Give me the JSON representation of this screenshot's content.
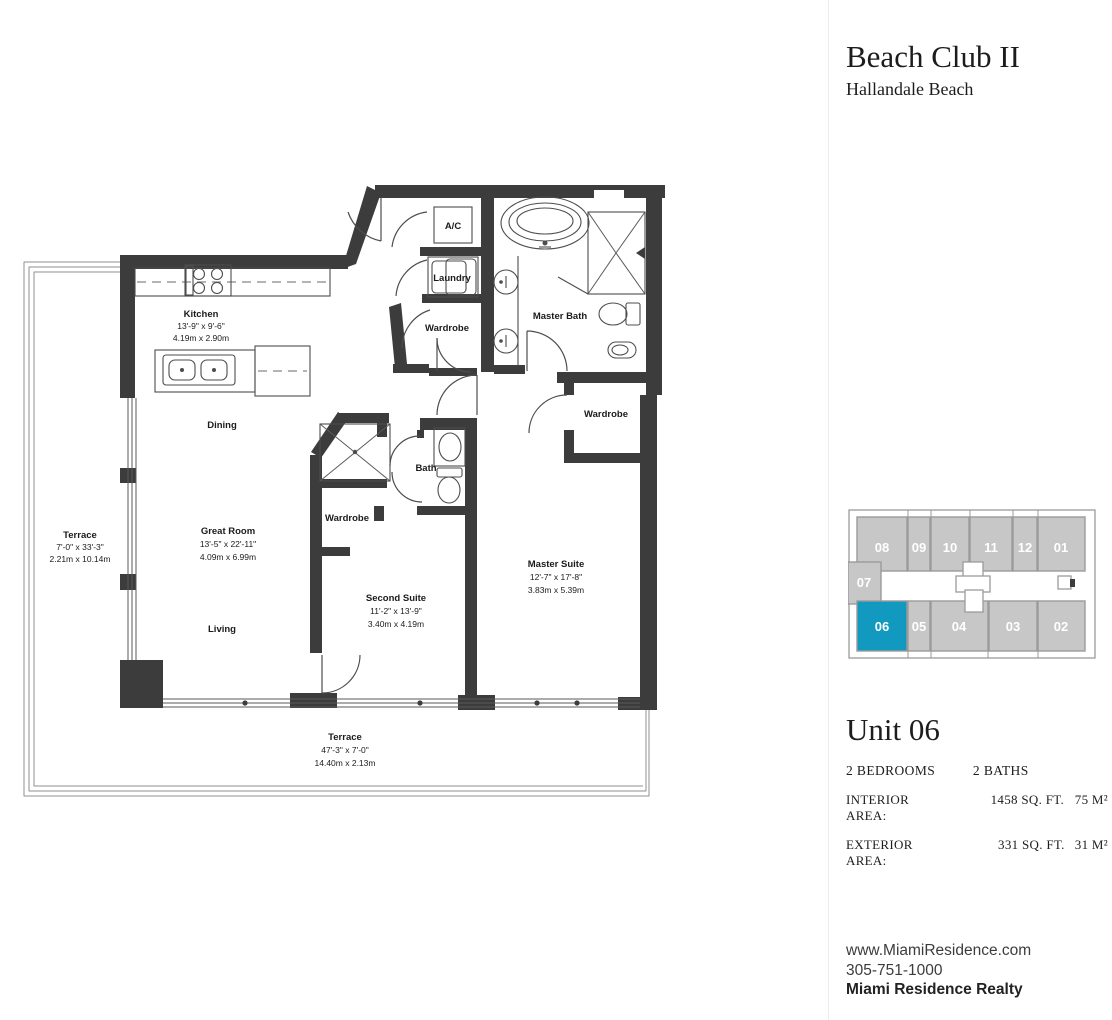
{
  "header": {
    "title": "Beach Club II",
    "subtitle": "Hallandale Beach"
  },
  "keyplan": {
    "highlight_color": "#1299bf",
    "highlighted_unit": "06",
    "units": [
      "08",
      "09",
      "10",
      "11",
      "12",
      "01",
      "07",
      "06",
      "05",
      "04",
      "03",
      "02"
    ]
  },
  "unit": {
    "name": "Unit 06",
    "bedrooms": "2 BEDROOMS",
    "baths": "2 BATHS",
    "interior_label": "INTERIOR AREA:",
    "interior_sqft": "1458 SQ. FT.",
    "interior_m2": "75 M²",
    "exterior_label": "EXTERIOR AREA:",
    "exterior_sqft": "331 SQ. FT.",
    "exterior_m2": "31 M²"
  },
  "contact": {
    "website": "www.MiamiResidence.com",
    "phone": "305-751-1000",
    "company": "Miami Residence Realty"
  },
  "floorplan": {
    "kitchen": {
      "name": "Kitchen",
      "ft": "13'-9\" x 9'-6\"",
      "m": "4.19m x 2.90m"
    },
    "dining": {
      "name": "Dining"
    },
    "living": {
      "name": "Living"
    },
    "great_room": {
      "name": "Great Room",
      "ft": "13'-5\" x 22'-11\"",
      "m": "4.09m x 6.99m"
    },
    "terrace_left": {
      "name": "Terrace",
      "ft": "7'-0\" x 33'-3\"",
      "m": "2.21m x 10.14m"
    },
    "terrace_bottom": {
      "name": "Terrace",
      "ft": "47'-3\" x 7'-0\"",
      "m": "14.40m x 2.13m"
    },
    "second_suite": {
      "name": "Second Suite",
      "ft": "11'-2\" x 13'-9\"",
      "m": "3.40m x 4.19m"
    },
    "master_suite": {
      "name": "Master Suite",
      "ft": "12'-7\" x 17'-8\"",
      "m": "3.83m x 5.39m"
    },
    "master_bath": {
      "name": "Master Bath"
    },
    "bath": {
      "name": "Bath"
    },
    "ac": {
      "name": "A/C"
    },
    "laundry": {
      "name": "Laundry"
    },
    "wardrobe_hall": {
      "name": "Wardrobe"
    },
    "wardrobe_second": {
      "name": "Wardrobe"
    },
    "wardrobe_master": {
      "name": "Wardrobe"
    }
  }
}
